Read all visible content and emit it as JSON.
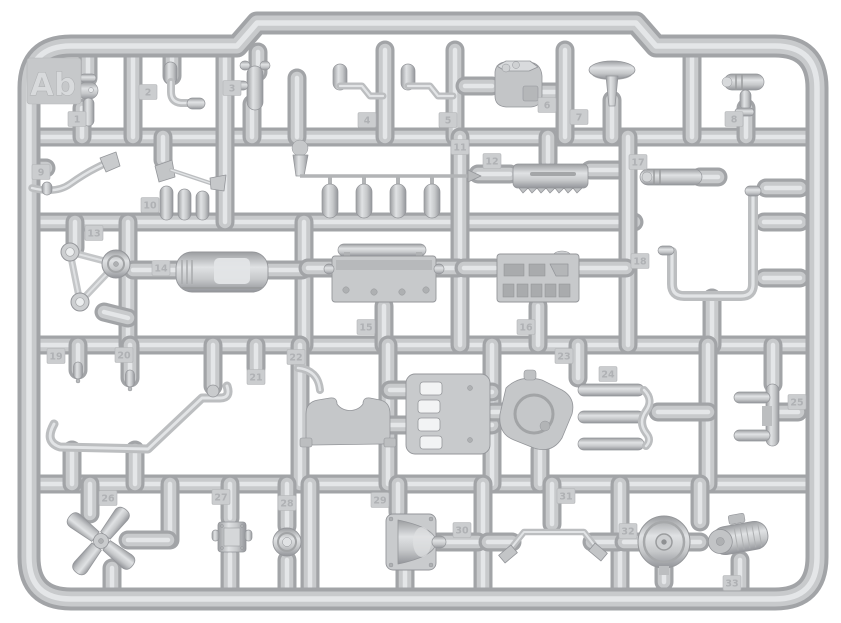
{
  "scene": {
    "description": "injection-molded model kit sprue photo, light gray plastic on white",
    "width": 841,
    "height": 623,
    "sprue_letter": "Ab"
  },
  "colors": {
    "background": "#ffffff",
    "runner_dark": "#a2a4a7",
    "runner_mid": "#c8cacc",
    "runner_light": "#e4e6e8",
    "part_base": "#c5c7c9",
    "part_dark": "#94969a",
    "part_light": "#e2e4e6",
    "tag_bg": "#cbcdcf",
    "tag_edge": "#b2b4b6",
    "tag_text": "#afb1b4",
    "label_bg": "#c6c8ca",
    "label_text": "#d8dadc"
  },
  "frame": {
    "x": 29,
    "y": 46,
    "right": 817,
    "bottom": 599,
    "radius": 42,
    "notch": {
      "x1": 237,
      "x2": 656,
      "y": 23
    }
  },
  "label": {
    "text": "Ab",
    "x": 53,
    "y": 84,
    "tile": [
      27,
      58,
      54,
      46
    ]
  },
  "runners": [
    [
      29,
      137,
      817,
      137
    ],
    [
      29,
      222,
      634,
      222
    ],
    [
      29,
      345,
      817,
      345
    ],
    [
      29,
      484,
      817,
      484
    ],
    [
      88,
      52,
      88,
      78
    ],
    [
      82,
      108,
      82,
      137
    ],
    [
      133,
      50,
      133,
      137
    ],
    [
      172,
      52,
      172,
      76
    ],
    [
      225,
      50,
      225,
      222
    ],
    [
      258,
      52,
      258,
      72
    ],
    [
      252,
      104,
      252,
      137
    ],
    [
      297,
      78,
      297,
      137
    ],
    [
      385,
      50,
      385,
      137
    ],
    [
      455,
      50,
      455,
      137
    ],
    [
      465,
      86,
      492,
      86
    ],
    [
      539,
      92,
      560,
      92
    ],
    [
      565,
      50,
      565,
      137
    ],
    [
      612,
      100,
      612,
      137
    ],
    [
      692,
      50,
      692,
      137
    ],
    [
      746,
      108,
      746,
      137
    ],
    [
      29,
      168,
      46,
      168
    ],
    [
      163,
      137,
      163,
      160
    ],
    [
      460,
      137,
      460,
      345
    ],
    [
      548,
      137,
      548,
      162
    ],
    [
      478,
      174,
      510,
      174
    ],
    [
      590,
      170,
      618,
      170
    ],
    [
      628,
      137,
      628,
      345
    ],
    [
      700,
      177,
      718,
      177
    ],
    [
      800,
      188,
      766,
      188
    ],
    [
      800,
      222,
      764,
      222
    ],
    [
      800,
      278,
      764,
      278
    ],
    [
      712,
      298,
      712,
      345
    ],
    [
      128,
      222,
      128,
      345
    ],
    [
      304,
      222,
      304,
      345
    ],
    [
      75,
      222,
      75,
      248
    ],
    [
      104,
      312,
      128,
      318
    ],
    [
      133,
      270,
      176,
      270
    ],
    [
      266,
      270,
      302,
      270
    ],
    [
      308,
      268,
      332,
      268
    ],
    [
      436,
      268,
      458,
      268
    ],
    [
      384,
      306,
      384,
      345
    ],
    [
      464,
      268,
      495,
      268
    ],
    [
      580,
      268,
      626,
      268
    ],
    [
      538,
      306,
      538,
      345
    ],
    [
      300,
      345,
      300,
      484
    ],
    [
      388,
      345,
      388,
      484
    ],
    [
      492,
      345,
      492,
      484
    ],
    [
      708,
      345,
      708,
      484
    ],
    [
      78,
      345,
      78,
      370
    ],
    [
      130,
      345,
      130,
      378
    ],
    [
      213,
      345,
      213,
      386
    ],
    [
      256,
      345,
      256,
      368
    ],
    [
      72,
      450,
      72,
      484
    ],
    [
      135,
      450,
      135,
      484
    ],
    [
      390,
      390,
      410,
      390
    ],
    [
      390,
      425,
      410,
      425
    ],
    [
      484,
      392,
      492,
      392
    ],
    [
      484,
      425,
      492,
      425
    ],
    [
      492,
      412,
      504,
      412
    ],
    [
      578,
      345,
      578,
      378
    ],
    [
      540,
      450,
      540,
      484
    ],
    [
      658,
      412,
      708,
      412
    ],
    [
      773,
      345,
      773,
      384
    ],
    [
      778,
      412,
      798,
      412
    ],
    [
      310,
      484,
      310,
      599
    ],
    [
      483,
      484,
      483,
      599
    ],
    [
      620,
      484,
      620,
      599
    ],
    [
      700,
      484,
      700,
      522
    ],
    [
      170,
      484,
      170,
      540
    ],
    [
      168,
      540,
      128,
      540
    ],
    [
      90,
      484,
      90,
      514
    ],
    [
      112,
      568,
      112,
      599
    ],
    [
      230,
      484,
      230,
      518
    ],
    [
      230,
      554,
      230,
      599
    ],
    [
      287,
      484,
      287,
      526
    ],
    [
      287,
      560,
      287,
      599
    ],
    [
      398,
      484,
      398,
      512
    ],
    [
      405,
      570,
      405,
      599
    ],
    [
      438,
      542,
      478,
      542
    ],
    [
      488,
      542,
      512,
      542
    ],
    [
      552,
      484,
      552,
      524
    ],
    [
      592,
      542,
      618,
      542
    ],
    [
      624,
      542,
      640,
      542
    ],
    [
      688,
      542,
      700,
      542
    ],
    [
      740,
      560,
      740,
      599
    ],
    [
      664,
      568,
      664,
      582
    ]
  ],
  "tags": [
    {
      "n": "1",
      "x": 77,
      "y": 119
    },
    {
      "n": "2",
      "x": 148,
      "y": 92
    },
    {
      "n": "3",
      "x": 232,
      "y": 88
    },
    {
      "n": "4",
      "x": 367,
      "y": 120
    },
    {
      "n": "5",
      "x": 448,
      "y": 120
    },
    {
      "n": "6",
      "x": 547,
      "y": 105
    },
    {
      "n": "7",
      "x": 579,
      "y": 117
    },
    {
      "n": "8",
      "x": 734,
      "y": 119
    },
    {
      "n": "9",
      "x": 41,
      "y": 172
    },
    {
      "n": "10",
      "x": 150,
      "y": 205
    },
    {
      "n": "11",
      "x": 460,
      "y": 147
    },
    {
      "n": "12",
      "x": 492,
      "y": 161
    },
    {
      "n": "13",
      "x": 94,
      "y": 233
    },
    {
      "n": "14",
      "x": 161,
      "y": 268
    },
    {
      "n": "15",
      "x": 366,
      "y": 327
    },
    {
      "n": "16",
      "x": 526,
      "y": 327
    },
    {
      "n": "17",
      "x": 638,
      "y": 162
    },
    {
      "n": "18",
      "x": 640,
      "y": 261
    },
    {
      "n": "19",
      "x": 56,
      "y": 356
    },
    {
      "n": "20",
      "x": 124,
      "y": 355
    },
    {
      "n": "21",
      "x": 256,
      "y": 377
    },
    {
      "n": "22",
      "x": 296,
      "y": 357
    },
    {
      "n": "23",
      "x": 564,
      "y": 356
    },
    {
      "n": "24",
      "x": 608,
      "y": 374
    },
    {
      "n": "25",
      "x": 797,
      "y": 402
    },
    {
      "n": "26",
      "x": 108,
      "y": 498
    },
    {
      "n": "27",
      "x": 221,
      "y": 497
    },
    {
      "n": "28",
      "x": 287,
      "y": 503
    },
    {
      "n": "29",
      "x": 380,
      "y": 500
    },
    {
      "n": "30",
      "x": 462,
      "y": 530
    },
    {
      "n": "31",
      "x": 566,
      "y": 496
    },
    {
      "n": "32",
      "x": 628,
      "y": 531
    },
    {
      "n": "33",
      "x": 732,
      "y": 583
    }
  ],
  "parts": [
    {
      "kind": "valve",
      "num": "1",
      "x": 88,
      "y": 92
    },
    {
      "kind": "elbow",
      "num": "2",
      "x": 171,
      "y": 82
    },
    {
      "kind": "tpipe",
      "num": "3",
      "x": 255,
      "y": 66
    },
    {
      "kind": "armknob",
      "num": "4",
      "x": 340,
      "y": 64,
      "arm": 383
    },
    {
      "kind": "armknob",
      "num": "5",
      "x": 408,
      "y": 64,
      "arm": 453
    },
    {
      "kind": "pumpbox",
      "num": "6",
      "x": 495,
      "y": 62
    },
    {
      "kind": "mushroom",
      "num": "7",
      "x": 612,
      "y": 66
    },
    {
      "kind": "scope",
      "num": "8",
      "x": 744,
      "y": 78
    },
    {
      "kind": "hose",
      "num": "9",
      "x": 48,
      "y": 168
    },
    {
      "kind": "funnel",
      "num": "10",
      "x": 155,
      "y": 164
    },
    {
      "kind": "rail",
      "num": "11",
      "x": 300,
      "y": 148
    },
    {
      "kind": "rack",
      "num": "12",
      "x": 513,
      "y": 164
    },
    {
      "kind": "pulleytri",
      "num": "13",
      "x": 88,
      "y": 276
    },
    {
      "kind": "tank",
      "num": "14",
      "x": 176,
      "y": 252
    },
    {
      "kind": "bed",
      "num": "15",
      "x": 332,
      "y": 244
    },
    {
      "kind": "panel",
      "num": "16",
      "x": 497,
      "y": 254
    },
    {
      "kind": "capsulepart",
      "num": "17",
      "x": 640,
      "y": 169
    },
    {
      "kind": "longpipe",
      "num": "18",
      "x": 672,
      "y": 190
    },
    {
      "kind": "pin",
      "num": "19",
      "x": 78,
      "y": 362
    },
    {
      "kind": "pin",
      "num": "20",
      "x": 130,
      "y": 370
    },
    {
      "kind": "chassis",
      "num": "21",
      "x": 52,
      "y": 386
    },
    {
      "kind": "ubracket",
      "num": "22",
      "x": 304,
      "y": 396
    },
    {
      "kind": "ladder",
      "num": "",
      "x": 406,
      "y": 374
    },
    {
      "kind": "gearblob",
      "num": "23",
      "x": 500,
      "y": 378
    },
    {
      "kind": "candelabra",
      "num": "24",
      "x": 578,
      "y": 382
    },
    {
      "kind": "hpart",
      "num": "25",
      "x": 734,
      "y": 384
    },
    {
      "kind": "xfan",
      "num": "26",
      "x": 101,
      "y": 541
    },
    {
      "kind": "block",
      "num": "27",
      "x": 216,
      "y": 520
    },
    {
      "kind": "smallpulley",
      "num": "28",
      "x": 287,
      "y": 542
    },
    {
      "kind": "bellcover",
      "num": "29",
      "x": 386,
      "y": 514
    },
    {
      "kind": "swaybar",
      "num": "31",
      "x": 508,
      "y": 528
    },
    {
      "kind": "disc",
      "num": "32",
      "x": 664,
      "y": 542
    },
    {
      "kind": "generator",
      "num": "33",
      "x": 740,
      "y": 538
    }
  ]
}
